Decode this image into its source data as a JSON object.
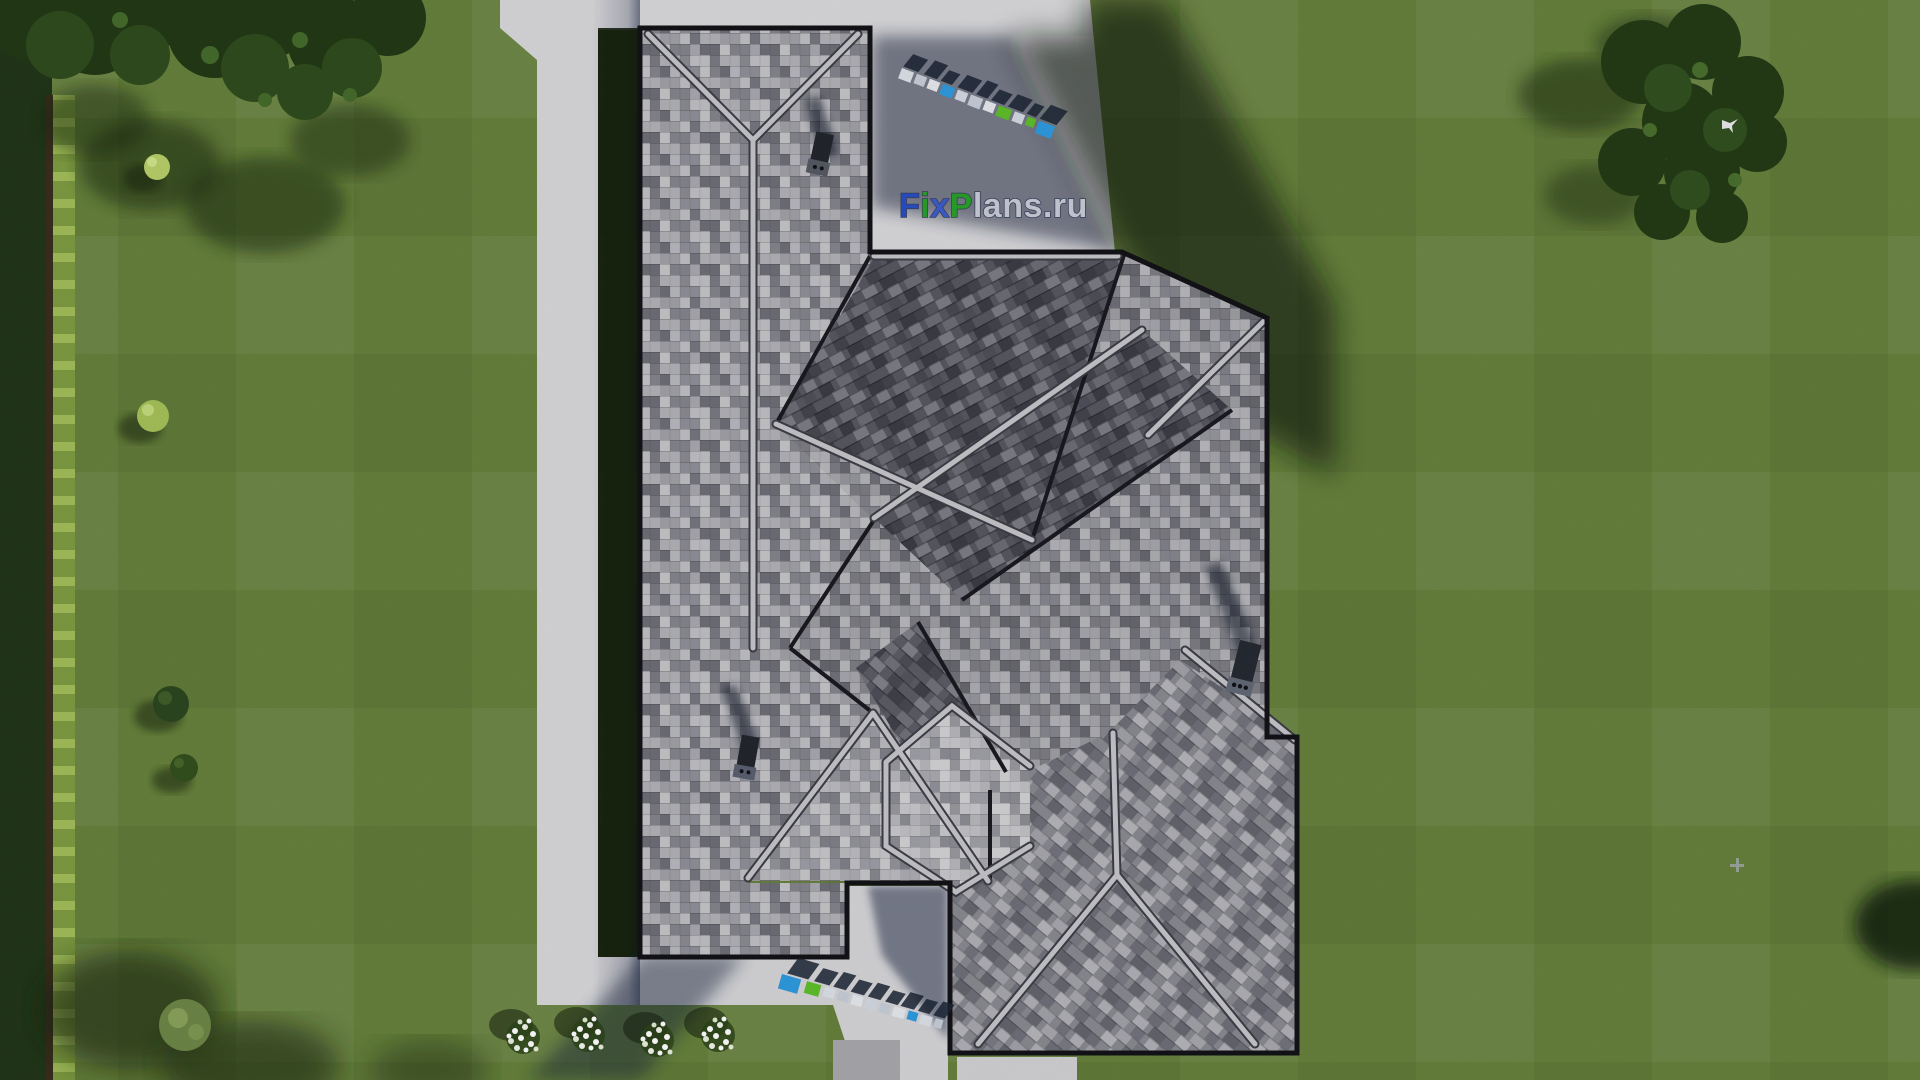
{
  "scene": {
    "description": "Aerial top-down 3D render of a gray shingled hip-and-gable roof house with lawn, driveway, walkways, trees and flower bed",
    "watermark_site": "FixPlans.ru"
  },
  "logo": {
    "parts": [
      {
        "t": "F",
        "c": "#2a4fc5"
      },
      {
        "t": "i",
        "c": "#2aa02a"
      },
      {
        "t": "x",
        "c": "#3d5ecf"
      },
      {
        "t": "P",
        "c": "#2aa02a"
      },
      {
        "t": "lans",
        "c": "#c9cdd8"
      },
      {
        "t": ".",
        "c": "#c9cdd8"
      },
      {
        "t": "ru",
        "c": "#c9cdd8"
      }
    ]
  },
  "palette": {
    "grass": "#67823d",
    "grass_shadow": "#0d1607",
    "pavement": "#d9d9dc",
    "shadow_navy": "#1b2742",
    "roof_mid": "#97979e",
    "roof_dark": "#585862",
    "roof_light": "#c2c2c7",
    "ridge_cap": "#c6c6cb",
    "eave": "#131318",
    "foliage": "#2b431d",
    "hedge_bright": "#a3bf5a",
    "flower": "#ffffff",
    "wm_blue": "#2f9be0",
    "wm_green": "#5fbf2a",
    "wm_navy": "#1c2535"
  }
}
